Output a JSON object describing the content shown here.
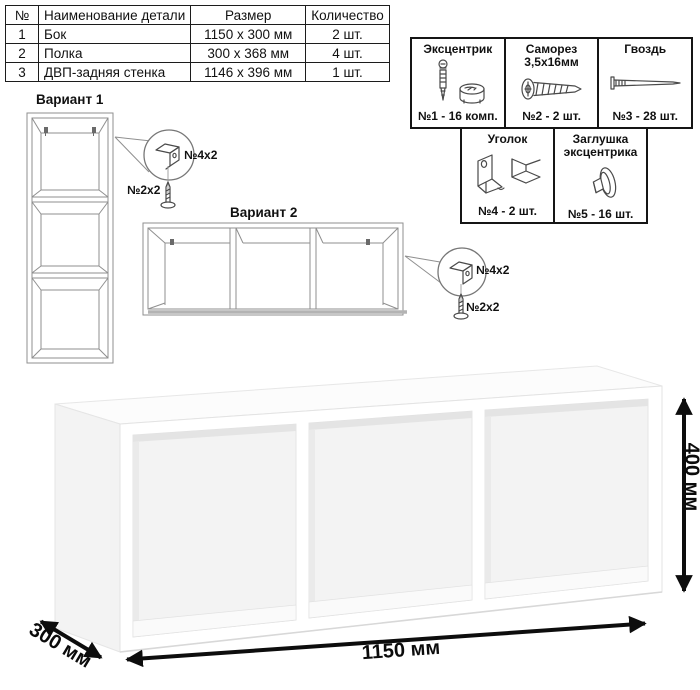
{
  "table": {
    "headers": [
      "№",
      "Наименование детали",
      "Размер",
      "Количество"
    ],
    "rows": [
      {
        "num": "1",
        "name": "Бок",
        "size": "1150 х 300 мм",
        "qty": "2 шт."
      },
      {
        "num": "2",
        "name": "Полка",
        "size": "300 х 368 мм",
        "qty": "4 шт."
      },
      {
        "num": "3",
        "name": "ДВП-задняя стенка",
        "size": "1146 х 396 мм",
        "qty": "1 шт."
      }
    ]
  },
  "hardware": {
    "items": [
      {
        "line1": "Эксцентрик",
        "line2": "",
        "count": "№1 - 16 комп.",
        "icon": "cam-lock-icon"
      },
      {
        "line1": "Саморез",
        "line2": "3,5х16мм",
        "count": "№2 - 2 шт.",
        "icon": "screw-icon"
      },
      {
        "line1": "Гвоздь",
        "line2": "",
        "count": "№3 - 28 шт.",
        "icon": "nail-icon"
      },
      {
        "line1": "Уголок",
        "line2": "",
        "count": "№4 - 2 шт.",
        "icon": "corner-bracket-icon"
      },
      {
        "line1": "Заглушка",
        "line2": "эксцентрика",
        "count": "№5 - 16 шт.",
        "icon": "eccentric-cap-icon"
      }
    ]
  },
  "variants": {
    "v1": {
      "label": "Вариант 1",
      "bracket_qty": "№4х2",
      "screw_qty": "№2х2"
    },
    "v2": {
      "label": "Вариант 2",
      "bracket_qty": "№4х2",
      "screw_qty": "№2х2"
    }
  },
  "dimensions": {
    "width": "1150 мм",
    "depth": "300 мм",
    "height": "400 мм"
  },
  "colors": {
    "arrow": "#0d0d0d",
    "drawing_line": "#8f8f8f",
    "background": "#ffffff"
  }
}
